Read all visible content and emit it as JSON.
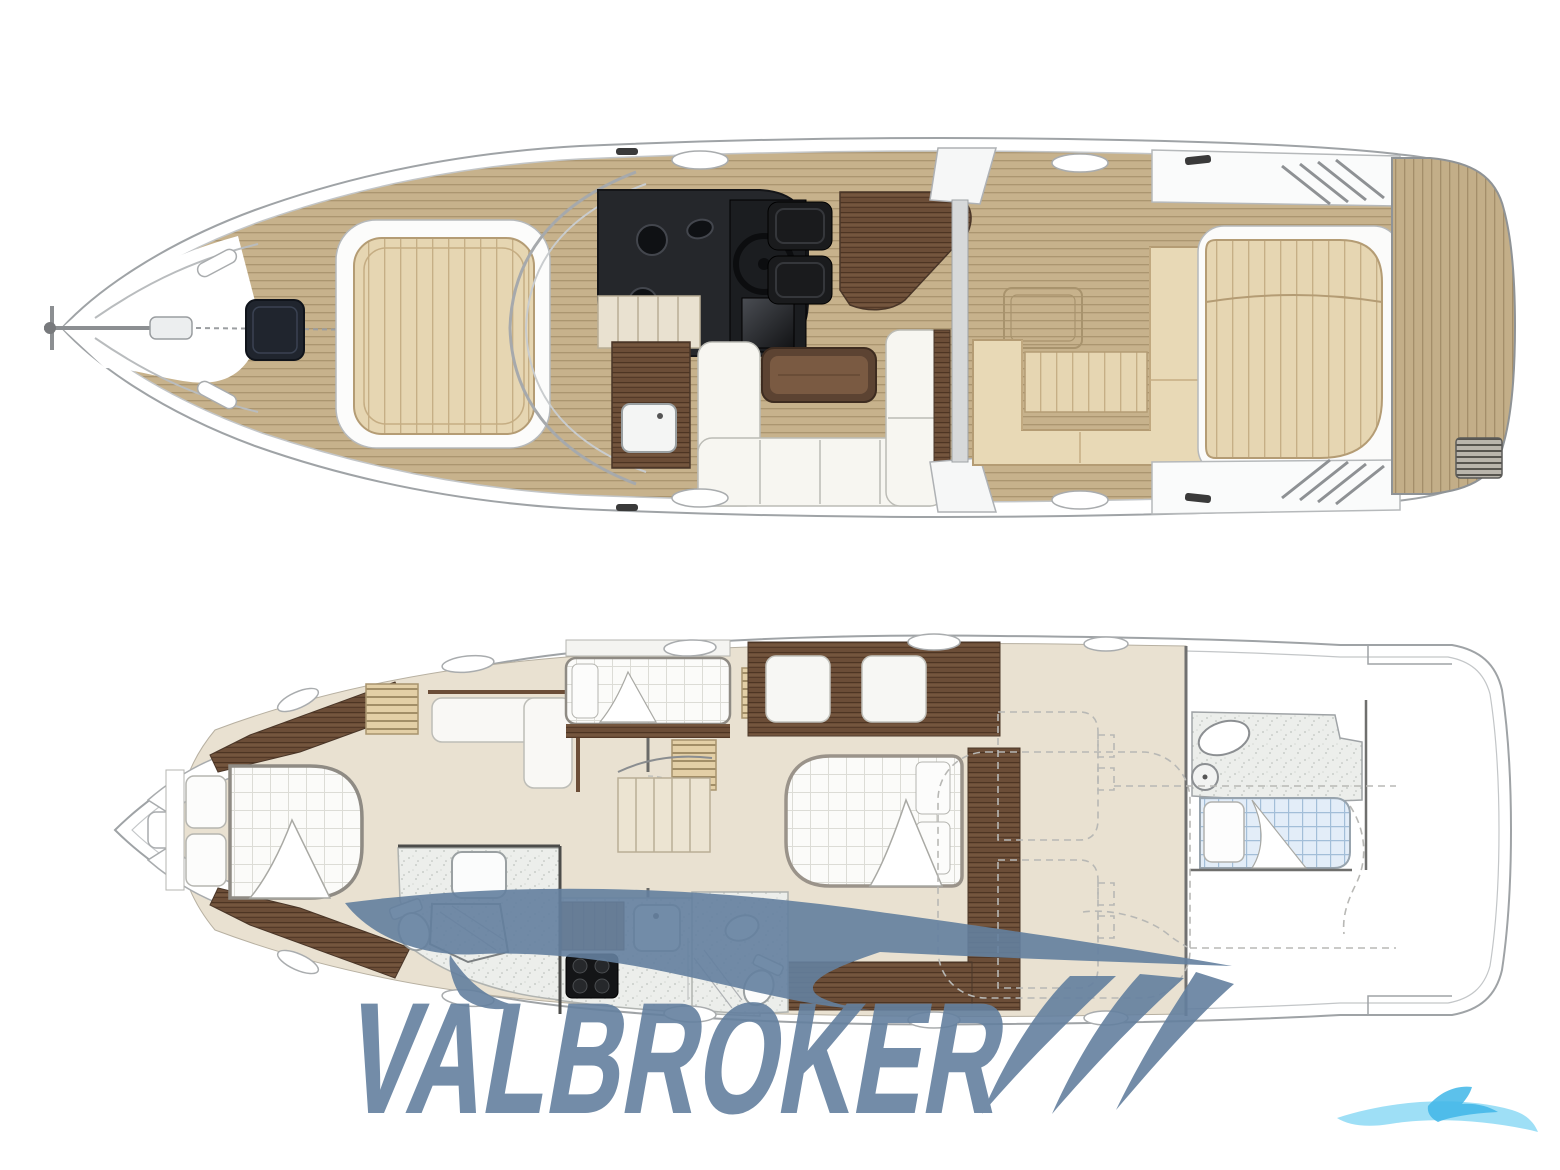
{
  "watermark": {
    "text": "VALBROKER",
    "color": "#64809f",
    "slash_count": 3,
    "opacity": 0.9
  },
  "corner_logo": {
    "color_primary": "#86d7f4",
    "color_accent": "#3fb6e8"
  },
  "figures": {
    "upper": "main-deck-plan",
    "lower": "lower-deck-plan"
  },
  "palette": {
    "background": "#ffffff",
    "hull_outline": "#9fa3a6",
    "hull_inner_line": "#c3c6c8",
    "teak_deck": "#c7b28c",
    "teak_stripe": "#a8936d",
    "cushion_tan": "#e6d6b2",
    "cushion_tan_stripe": "#c5ad83",
    "sofa_white": "#f7f6f1",
    "wood_dark": "#6b4d37",
    "console_dark": "#25272b",
    "bed_white": "#fbfbf9",
    "bed_grid": "#dcdcd6",
    "crew_bed_blue": "#e3edf8",
    "crew_bed_grid": "#a3bed8",
    "bathroom_floor": "#eceeeb",
    "interior_floor": "#e9e1d1"
  }
}
